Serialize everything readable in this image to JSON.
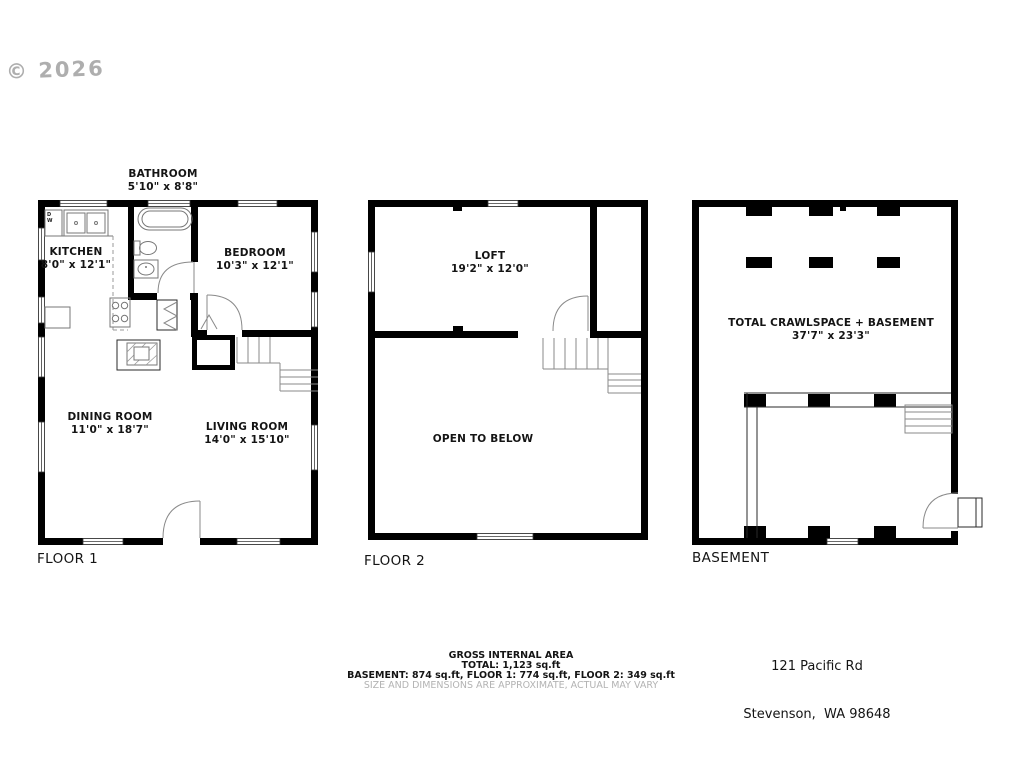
{
  "watermark": "© 2026",
  "floors": {
    "floor1": {
      "name": "FLOOR 1",
      "bathroom": {
        "label": "BATHROOM",
        "dims": "5'10\" x 8'8\""
      },
      "kitchen": {
        "label": "KITCHEN",
        "dims": "8'0\" x 12'1\""
      },
      "bedroom": {
        "label": "BEDROOM",
        "dims": "10'3\" x 12'1\""
      },
      "dining_room": {
        "label": "DINING ROOM",
        "dims": "11'0\" x 18'7\""
      },
      "living_room": {
        "label": "LIVING ROOM",
        "dims": "14'0\" x 15'10\""
      },
      "dishwasher": {
        "line1": "D",
        "line2": "W"
      }
    },
    "floor2": {
      "name": "FLOOR 2",
      "loft": {
        "label": "LOFT",
        "dims": "19'2\" x 12'0\""
      },
      "open_to_below": {
        "label": "OPEN TO BELOW"
      }
    },
    "basement": {
      "name": "BASEMENT",
      "crawlspace": {
        "label": "TOTAL CRAWLSPACE + BASEMENT",
        "dims": "37'7\" x 23'3\""
      }
    }
  },
  "address": {
    "line1": "121 Pacific Rd",
    "line2": "Stevenson,  WA 98648"
  },
  "area_summary": {
    "title": "GROSS INTERNAL AREA",
    "total": "TOTAL: 1,123 sq.ft",
    "breakdown": "BASEMENT: 874 sq.ft, FLOOR 1: 774 sq.ft, FLOOR 2: 349 sq.ft",
    "disclaimer": "SIZE AND DIMENSIONS ARE APPROXIMATE, ACTUAL MAY VARY"
  },
  "colors": {
    "wall": "#000000",
    "text": "#141414",
    "muted": "#b3b3b3",
    "watermark": "#9a9a9a"
  }
}
